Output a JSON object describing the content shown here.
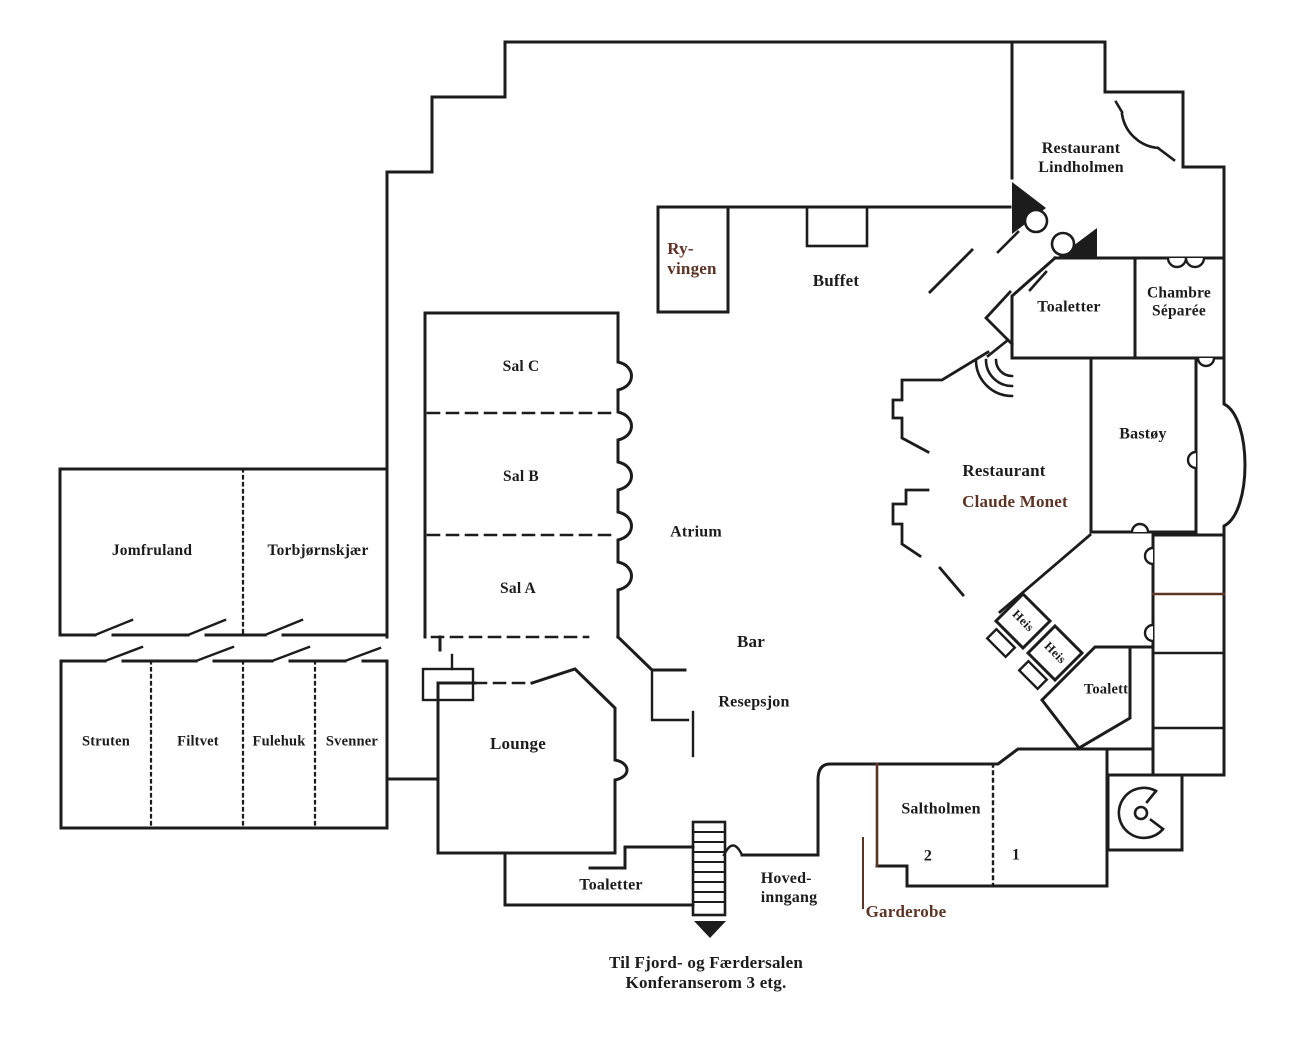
{
  "title": "Hotel ground floor plan",
  "colors": {
    "wall": "#1c1c1c",
    "accent_brown": "#5d3426",
    "background": "#ffffff"
  },
  "rooms": {
    "restaurant_lindholmen": "Restaurant\nLindholmen",
    "ryvingen": "Ry-\nvingen",
    "buffet": "Buffet",
    "toaletter_top": "Toaletter",
    "chambre_separee": "Chambre\nSéparée",
    "bastoy": "Bastøy",
    "sal_c": "Sal C",
    "sal_b": "Sal B",
    "sal_a": "Sal A",
    "atrium": "Atrium",
    "restaurant_claude_monet_line1": "Restaurant",
    "restaurant_claude_monet_line2": "Claude Monet",
    "jomfruland": "Jomfruland",
    "torbjornskjaer": "Torbjørnskjær",
    "struten": "Struten",
    "filtvet": "Filtvet",
    "fulehuk": "Fulehuk",
    "svenner": "Svenner",
    "bar": "Bar",
    "resepsjon": "Resepsjon",
    "lounge": "Lounge",
    "heis_1": "Heis",
    "heis_2": "Heis",
    "toalett": "Toalett",
    "saltholmen": "Saltholmen",
    "saltholmen_2": "2",
    "saltholmen_1": "1",
    "toaletter_bottom": "Toaletter",
    "hovedinngang": "Hoved-\ninngang",
    "garderobe": "Garderobe"
  },
  "footer": {
    "note": "Til Fjord- og Færdersalen\nKonferanserom 3 etg."
  },
  "icons": {
    "stairs": "stairs-icon",
    "entrance_arrow": "down-arrow-icon",
    "spiral_staircase": "spiral-staircase-icon",
    "elevator_1": "elevator-icon",
    "elevator_2": "elevator-icon",
    "door_swing": "door-swing-icon",
    "revolving_entrance": "revolving-door-icon"
  }
}
